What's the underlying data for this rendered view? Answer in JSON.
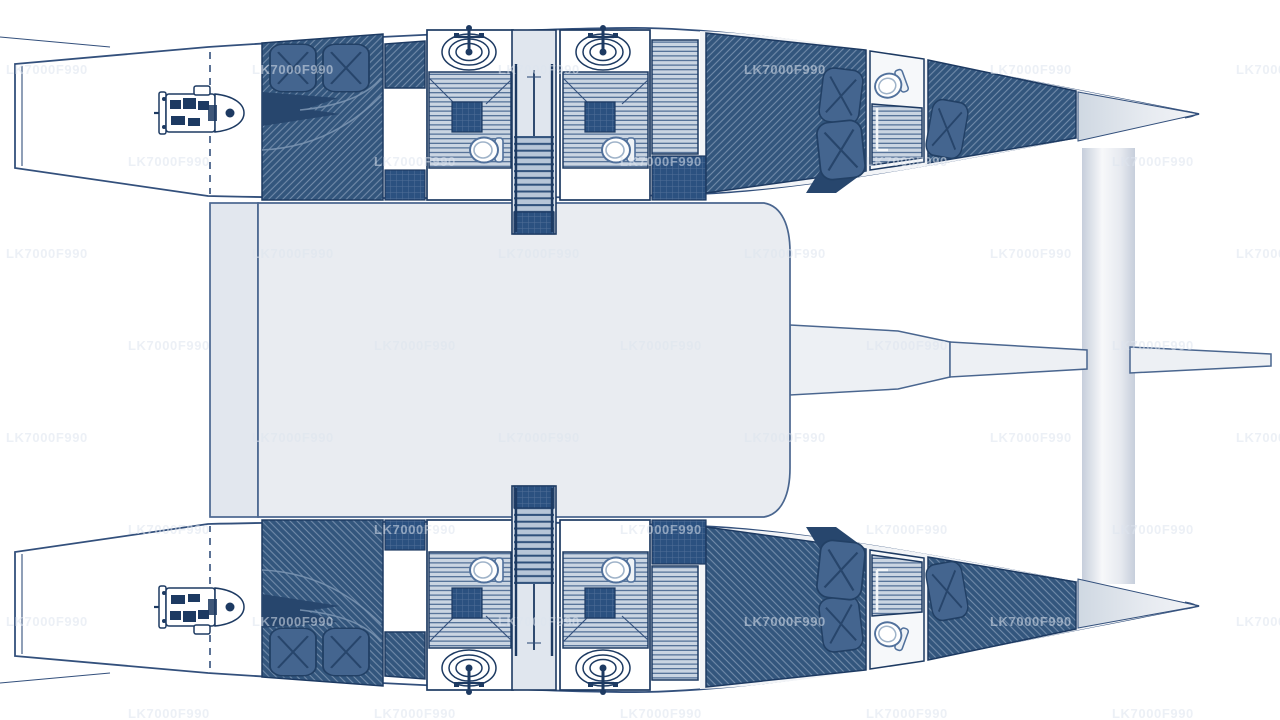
{
  "canvas": {
    "width": 1280,
    "height": 720,
    "background": "#ffffff"
  },
  "watermark": {
    "text": "LK7000F990",
    "color": "#dde4ee",
    "opacity": 0.55
  },
  "colors": {
    "white": "#ffffff",
    "outline": "#33507c",
    "outlineDark": "#1d3a62",
    "cabin": "#33567d",
    "hatchLine": "#7e96b3",
    "shade": "#27466d",
    "block": "#2b5180",
    "pillow": "#44658f",
    "pillowSeam": "#224065",
    "slatBg": "#cad5e2",
    "slatLine": "#40618b",
    "treadBg": "#b7c6d8",
    "treadLine": "#2e507b",
    "floorLight": "#e0e6ee",
    "saloon": "#e9ecf1",
    "cockpit": "#e2e7ee",
    "deck": "#f2f4f7",
    "beam": "#edf0f4",
    "beamStroke": "#4a668f",
    "toiletRim": "#51719c"
  },
  "plan": {
    "vessel_type": "catamaran",
    "view": "overhead-deck-plan",
    "hulls": [
      {
        "id": "port",
        "features": [
          "engine",
          "aft-double-cabin",
          "bathroom-with-sink-and-toilet",
          "companionway-stairs",
          "bathroom-with-sink-and-toilet",
          "corridor",
          "forward-double-cabin",
          "bow-head-toilet",
          "forepeak-berth"
        ]
      },
      {
        "id": "starboard",
        "features": [
          "engine",
          "aft-double-cabin",
          "bathroom-with-sink-and-toilet",
          "companionway-stairs",
          "bathroom-with-sink-and-toilet",
          "corridor",
          "forward-double-cabin",
          "bow-head-toilet",
          "forepeak-berth"
        ]
      }
    ],
    "shared": [
      "aft-cockpit",
      "saloon-bridge-deck",
      "forward-crossbeam",
      "bowsprit-beam"
    ],
    "counts": {
      "engines": 2,
      "double-berth-cabins": 4,
      "forepeak-berths": 2,
      "sinks": 4,
      "toilets": 6,
      "companionways": 2,
      "pillows": 10
    }
  }
}
